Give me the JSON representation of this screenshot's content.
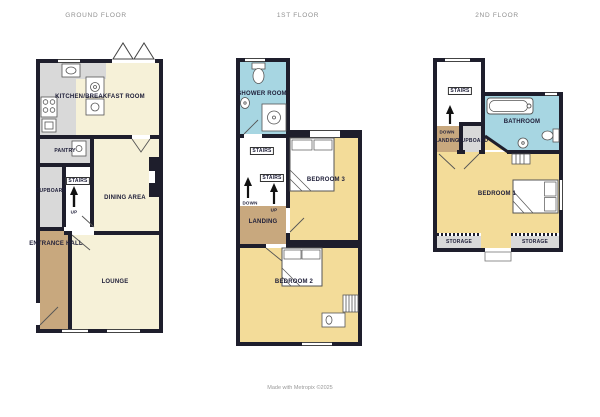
{
  "page": {
    "footer": "Made with Metropix ©2025"
  },
  "colors": {
    "wall": "#1e1e2c",
    "cream": "#f6f1d8",
    "yellow": "#f3dc99",
    "tan": "#c8a87e",
    "gray": "#d9d9d9",
    "blue": "#a7d6e2",
    "ink": "#20203a",
    "title": "#8f8f8f"
  },
  "floors": {
    "ground": {
      "title": "GROUND FLOOR",
      "rooms": {
        "kitchen": "KITCHEN/BREAKFAST ROOM",
        "pantry": "PANTRY",
        "cupboard": "CUPBOARD",
        "stairs": "STAIRS",
        "dining": "DINING AREA",
        "hall": "ENTRANCE HALL",
        "lounge": "LOUNGE"
      },
      "stairs_up": "UP"
    },
    "first": {
      "title": "1ST FLOOR",
      "rooms": {
        "shower": "SHOWER ROOM",
        "stairs_upper": "STAIRS",
        "stairs_lower": "STAIRS",
        "landing": "LANDING",
        "bedroom3": "BEDROOM 3",
        "bedroom2": "BEDROOM 2"
      },
      "stairs_up": "UP",
      "stairs_down": "DOWN"
    },
    "second": {
      "title": "2ND FLOOR",
      "rooms": {
        "stairs": "STAIRS",
        "landing": "LANDING",
        "cupboard": "CUPBOARD",
        "bathroom": "BATHROOM",
        "bedroom1": "BEDROOM 1",
        "storage_left": "STORAGE",
        "storage_right": "STORAGE"
      },
      "stairs_down": "DOWN"
    }
  }
}
